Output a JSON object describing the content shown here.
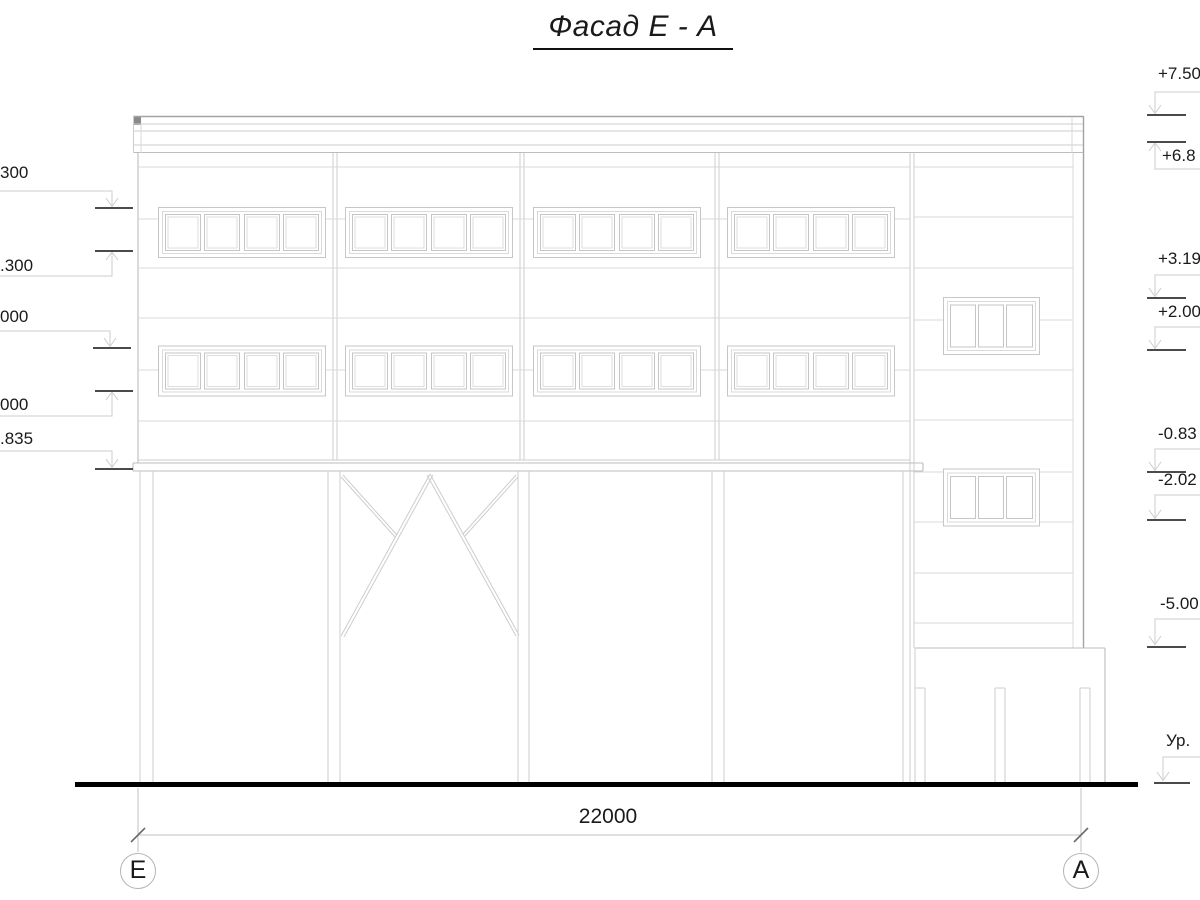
{
  "title": "Фасад Е - А",
  "dimensions": {
    "overall": "22000"
  },
  "axis_markers": {
    "left": "Е",
    "right": "А"
  },
  "elevations": {
    "left": [
      {
        "label": "300"
      },
      {
        "label": ".300"
      },
      {
        "label": "000"
      },
      {
        "label": "000"
      },
      {
        "label": ".835"
      }
    ],
    "right": [
      {
        "label": "+7.50"
      },
      {
        "label": "+6.8"
      },
      {
        "label": "+3.19"
      },
      {
        "label": "+2.00"
      },
      {
        "label": "-0.83"
      },
      {
        "label": "-2.02"
      },
      {
        "label": "-5.00"
      },
      {
        "label": "Ур."
      }
    ]
  },
  "colors": {
    "drawing_line": "#cdcdcd",
    "outline": "#a3a3a3",
    "level_mark": "#4a4a4a",
    "ground_line": "#000000",
    "text": "#1a1a1a"
  }
}
